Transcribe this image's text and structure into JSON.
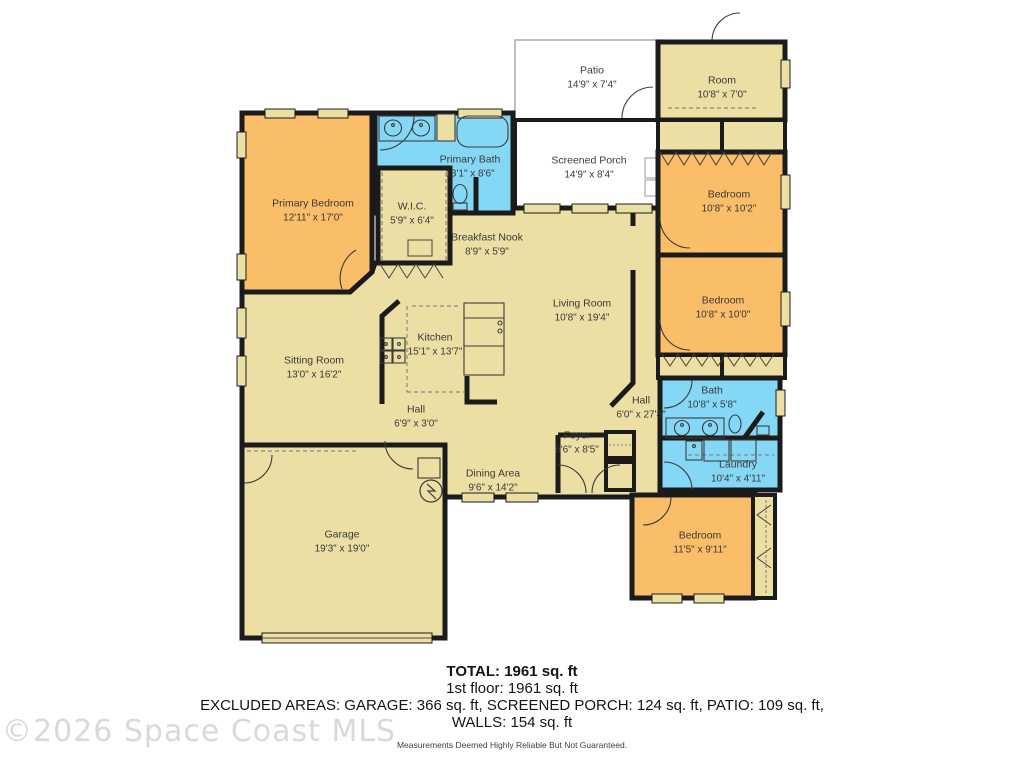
{
  "watermark": "©2026 Space Coast MLS",
  "rooms": [
    {
      "name": "Patio",
      "dims": "14'9\" x 7'4\""
    },
    {
      "name": "Room",
      "dims": "10'8\" x 7'0\""
    },
    {
      "name": "Screened Porch",
      "dims": "14'9\" x 8'4\""
    },
    {
      "name": "Primary Bath",
      "dims": "13'1\" x 8'6\""
    },
    {
      "name": "Primary Bedroom",
      "dims": "12'11\" x 17'0\""
    },
    {
      "name": "W.I.C.",
      "dims": "5'9\" x 6'4\""
    },
    {
      "name": "Breakfast Nook",
      "dims": "8'9\" x 5'9\""
    },
    {
      "name": "Bedroom",
      "dims": "10'8\" x 10'2\""
    },
    {
      "name": "Bedroom",
      "dims": "10'8\" x 10'0\""
    },
    {
      "name": "Living Room",
      "dims": "10'8\" x 19'4\""
    },
    {
      "name": "Sitting Room",
      "dims": "13'0\" x 16'2\""
    },
    {
      "name": "Kitchen",
      "dims": "15'1\" x 13'7\""
    },
    {
      "name": "Hall",
      "dims": "6'9\" x 3'0\""
    },
    {
      "name": "Hall",
      "dims": "6'0\" x 27'8\""
    },
    {
      "name": "Bath",
      "dims": "10'8\" x 5'8\""
    },
    {
      "name": "Foyer",
      "dims": "6'6\" x 8'5\""
    },
    {
      "name": "Laundry",
      "dims": "10'4\" x 4'11\""
    },
    {
      "name": "Dining Area",
      "dims": "9'6\" x 14'2\""
    },
    {
      "name": "Bedroom",
      "dims": "11'5\" x 9'11\""
    },
    {
      "name": "Garage",
      "dims": "19'3\" x 19'0\""
    }
  ],
  "summary": {
    "total": "TOTAL: 1961 sq. ft",
    "floor1": "1st floor: 1961 sq. ft",
    "excluded_line1": "EXCLUDED AREAS: GARAGE: 366 sq. ft, SCREENED PORCH: 124 sq. ft, PATIO: 109 sq. ft,",
    "excluded_line2": "WALLS: 154 sq. ft",
    "disclaimer": "Measurements Deemed Highly Reliable But Not Guaranteed."
  },
  "colors": {
    "bedroom_fill": "#FABD68",
    "common_fill": "#EBDFA4",
    "wet_fill": "#85D8F5",
    "wall": "#1B1B1B",
    "outdoor_fill": "#FFFFFF",
    "watermark_gray": "#D9D9D9"
  }
}
